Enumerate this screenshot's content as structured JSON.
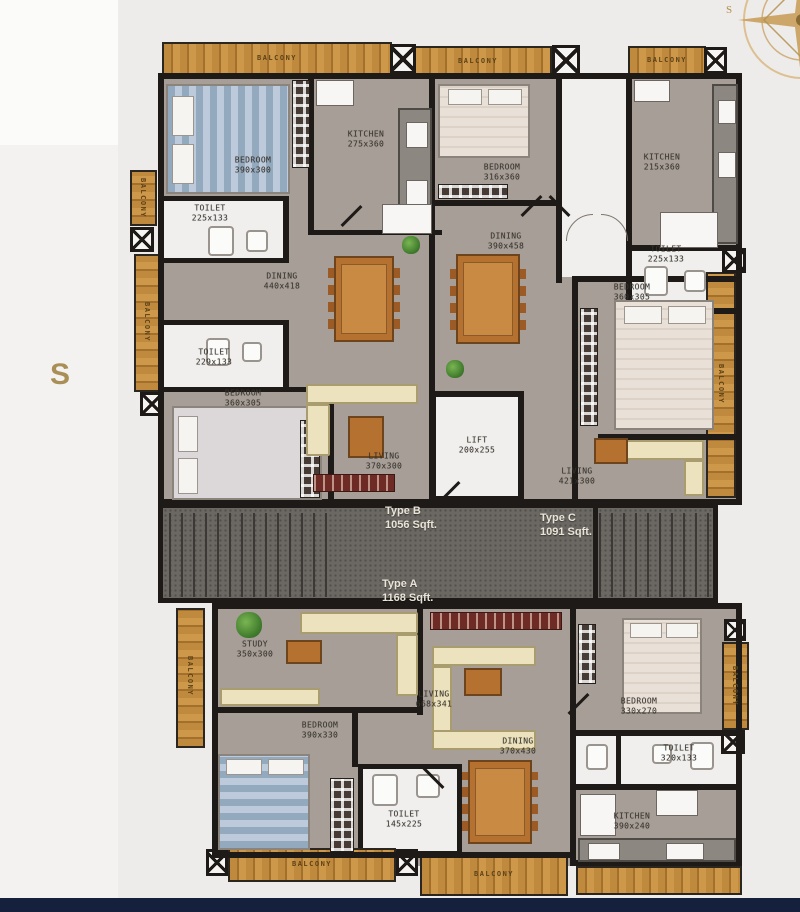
{
  "page": {
    "background": "#edecea",
    "bottom_bar_color": "#15203c",
    "side_letter": "S"
  },
  "compass": {
    "icon": "compass-rose",
    "color": "#c9a05c",
    "letter": "S"
  },
  "labels": {
    "balcony": "BALCONY"
  },
  "palette": {
    "wall": "#1d1a17",
    "floor": "#a69e97",
    "wood": "#bf8a3d",
    "stairs": "#6b6762",
    "white_room": "#f0efed",
    "table_wood": "#b5712f",
    "sofa": "#ece2bd",
    "accent_gold": "#a98f55"
  },
  "units": [
    {
      "label": "Type B",
      "area": "1056 Sqft."
    },
    {
      "label": "Type C",
      "area": "1091 Sqft."
    },
    {
      "label": "Type A",
      "area": "1168 Sqft."
    }
  ],
  "rooms": [
    {
      "name": "BEDROOM",
      "dims": "390x300"
    },
    {
      "name": "KITCHEN",
      "dims": "275x360"
    },
    {
      "name": "TOILET",
      "dims": "225x133"
    },
    {
      "name": "DINING",
      "dims": "440x418"
    },
    {
      "name": "TOILET",
      "dims": "229x133"
    },
    {
      "name": "BEDROOM",
      "dims": "360x305"
    },
    {
      "name": "LIVING",
      "dims": "370x300"
    },
    {
      "name": "BEDROOM",
      "dims": "316x360"
    },
    {
      "name": "DINING",
      "dims": "390x458"
    },
    {
      "name": "LIFT",
      "dims": "200x255"
    },
    {
      "name": "KITCHEN",
      "dims": "215x360"
    },
    {
      "name": "TOILET",
      "dims": "225x133"
    },
    {
      "name": "BEDROOM",
      "dims": "360x305"
    },
    {
      "name": "LIVING",
      "dims": "421x300"
    },
    {
      "name": "STUDY",
      "dims": "350x300"
    },
    {
      "name": "LIVING",
      "dims": "668x341"
    },
    {
      "name": "BEDROOM",
      "dims": "390x330"
    },
    {
      "name": "TOILET",
      "dims": "145x225"
    },
    {
      "name": "DINING",
      "dims": "370x430"
    },
    {
      "name": "BEDROOM",
      "dims": "330x270"
    },
    {
      "name": "TOILET",
      "dims": "320x133"
    },
    {
      "name": "KITCHEN",
      "dims": "390x240"
    }
  ]
}
